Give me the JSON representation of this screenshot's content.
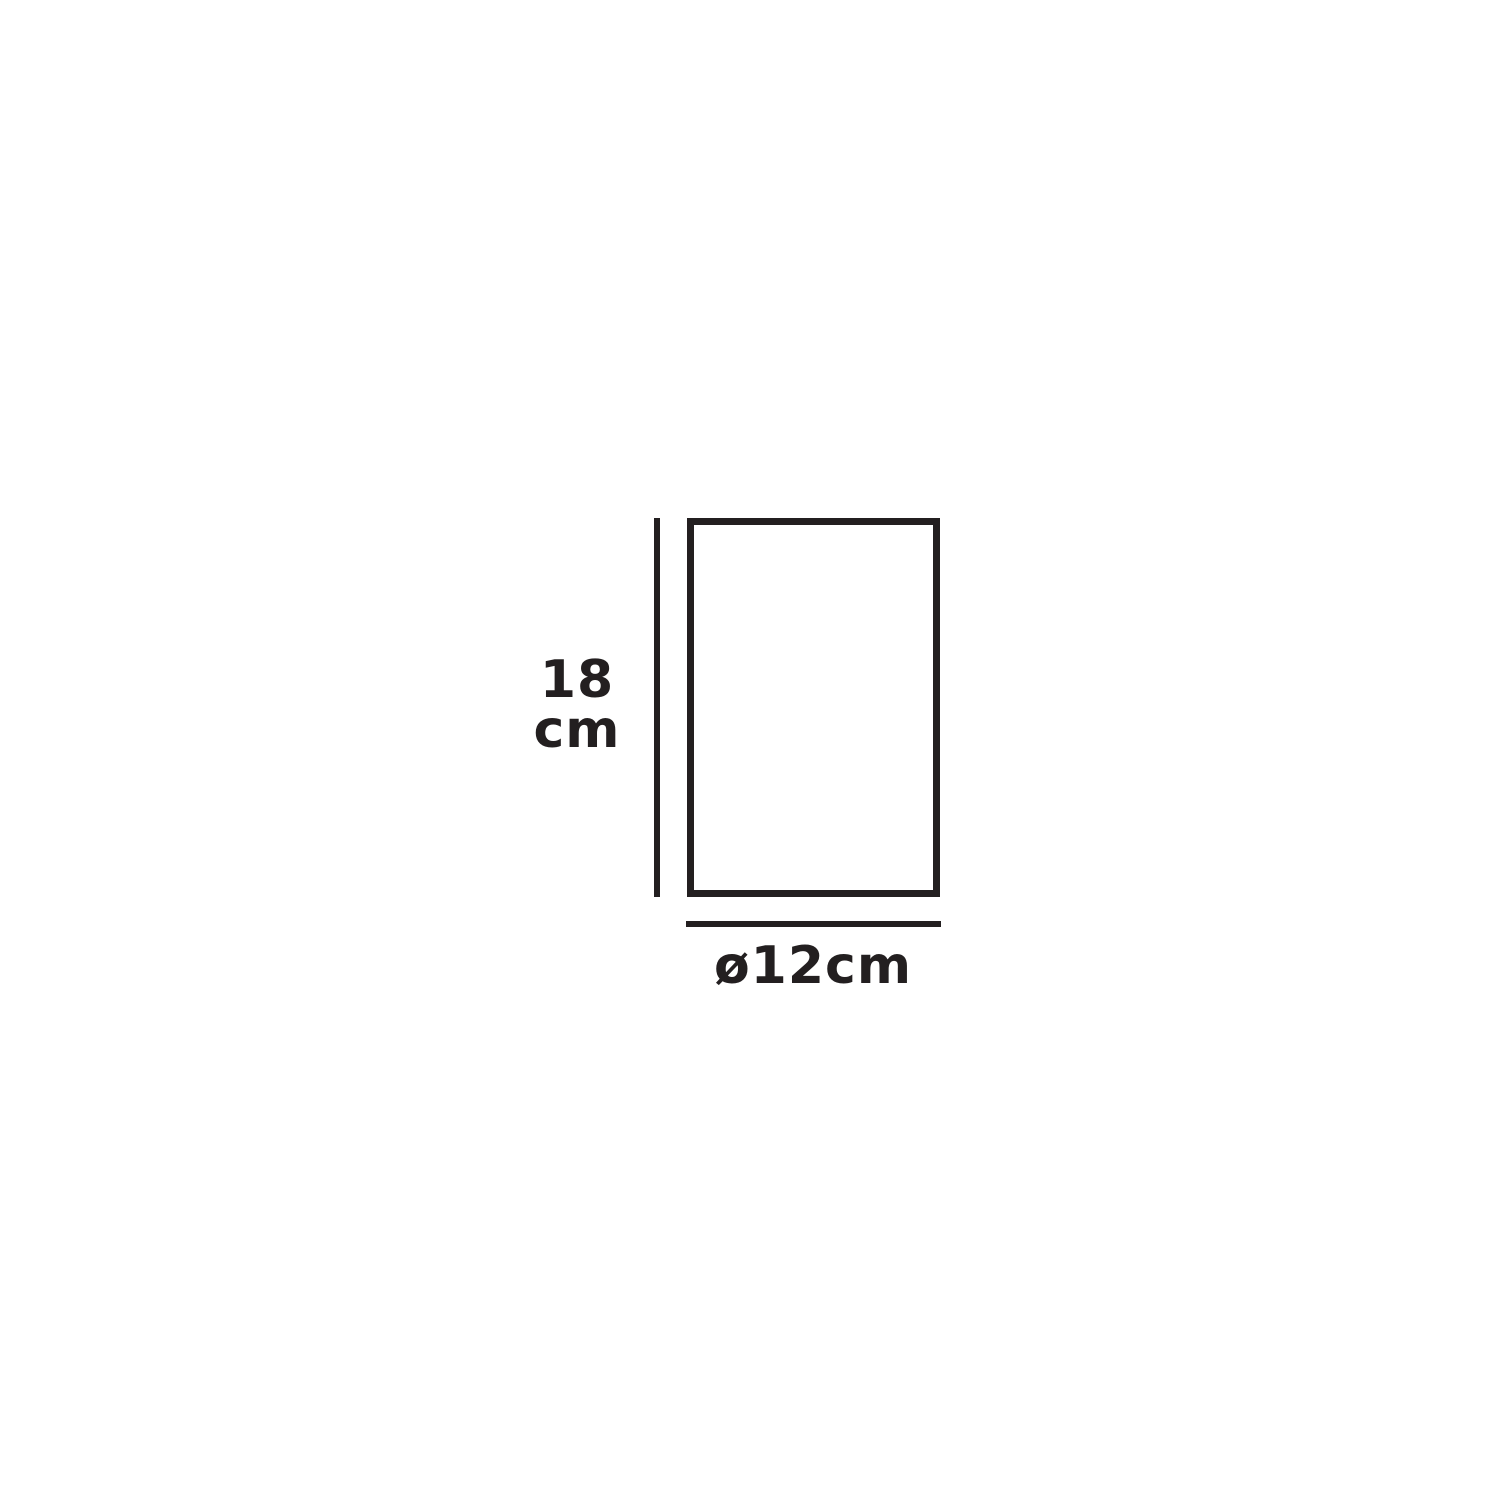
{
  "colors": {
    "ink": "#231f20",
    "bg": "#ffffff"
  },
  "diagram": {
    "type": "product-dimension-drawing",
    "shape": "rectangle-outline",
    "height_label": {
      "line1": "18",
      "line2": "cm"
    },
    "diameter_label": "ø12cm",
    "dimensions": {
      "height_value": "18",
      "height_unit": "cm",
      "diameter_value": "12",
      "diameter_unit": "cm",
      "diameter_symbol": "ø"
    }
  }
}
